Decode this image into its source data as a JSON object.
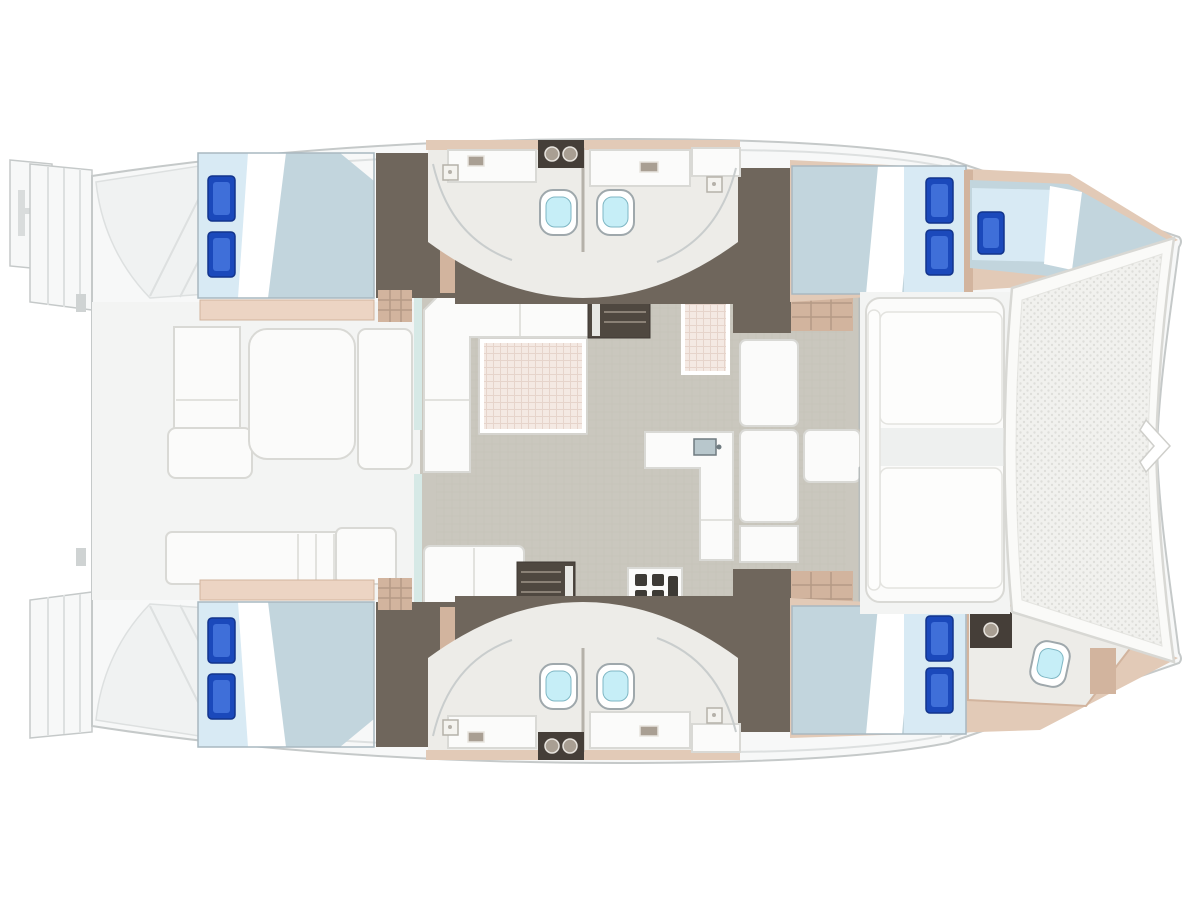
{
  "page": {
    "description": "Catamaran yacht accommodation floor plan, top-down view, bow to the right, stern to the left"
  },
  "palette": {
    "bg": "#ffffff",
    "deck": "#f7f8f8",
    "deck_line": "#c5c9c9",
    "deck_inner_line": "#dde0e0",
    "moulding": "#f0f2f2",
    "cockpit_sole": "#f3f4f3",
    "floor_grey": "#cac7be",
    "corridor_brown": "#6f665c",
    "stairs_dark": "#4f4840",
    "tan": "#e2cab7",
    "tan_dark": "#d2b49e",
    "bench_tan": "#ecd4c3",
    "cabin_floor": "#edece8",
    "duvet": "#c2d5dd",
    "bed_light": "#d8eaf4",
    "pillow": "#1b49bb",
    "pillow_light": "#3f6fd9",
    "white_furn": "#fbfbfa",
    "furn_line": "#d9d9d5",
    "table_pink": "#f4e9e3",
    "toilet_cyan": "#c6eef7",
    "fixture_dark": "#453e38",
    "fixture_mid": "#a99f93",
    "tramp": "#f1f1ee",
    "tramp_dot": "#dededa",
    "aqua": "#d6e9e6",
    "sink_steel": "#b8c7cc"
  },
  "rooms": [
    {
      "id": "stern-platforms",
      "label": "stern transom platforms with steps and swim ladder"
    },
    {
      "id": "aft-cockpit",
      "label": "aft cockpit with table, L-bench, lounge and aft bench row"
    },
    {
      "id": "salon",
      "label": "salon with U-sofa and dining table"
    },
    {
      "id": "galley",
      "label": "galley with L-counter, sink, fridge and stove"
    },
    {
      "id": "port-aft-cabin",
      "label": "port aft double cabin"
    },
    {
      "id": "port-heads",
      "label": "port back-to-back heads with two toilets, vanities and showers"
    },
    {
      "id": "port-forward-cabin",
      "label": "port forward double cabin"
    },
    {
      "id": "forepeak-berth",
      "label": "port forepeak crew berth"
    },
    {
      "id": "starboard-aft-cabin",
      "label": "starboard aft double cabin"
    },
    {
      "id": "starboard-heads",
      "label": "starboard back-to-back heads with two toilets and vanities"
    },
    {
      "id": "starboard-forward-cabin",
      "label": "starboard forward double cabin"
    },
    {
      "id": "starboard-forward-head",
      "label": "starboard forward head with toilet and sink"
    },
    {
      "id": "forward-cockpit",
      "label": "forward cockpit seating"
    },
    {
      "id": "trampoline",
      "label": "bow trampoline net"
    }
  ],
  "counts": {
    "double_beds": 4,
    "single_berths": 1,
    "toilets": 5,
    "blue_pillows": 9,
    "cockpit_tables": 2
  }
}
